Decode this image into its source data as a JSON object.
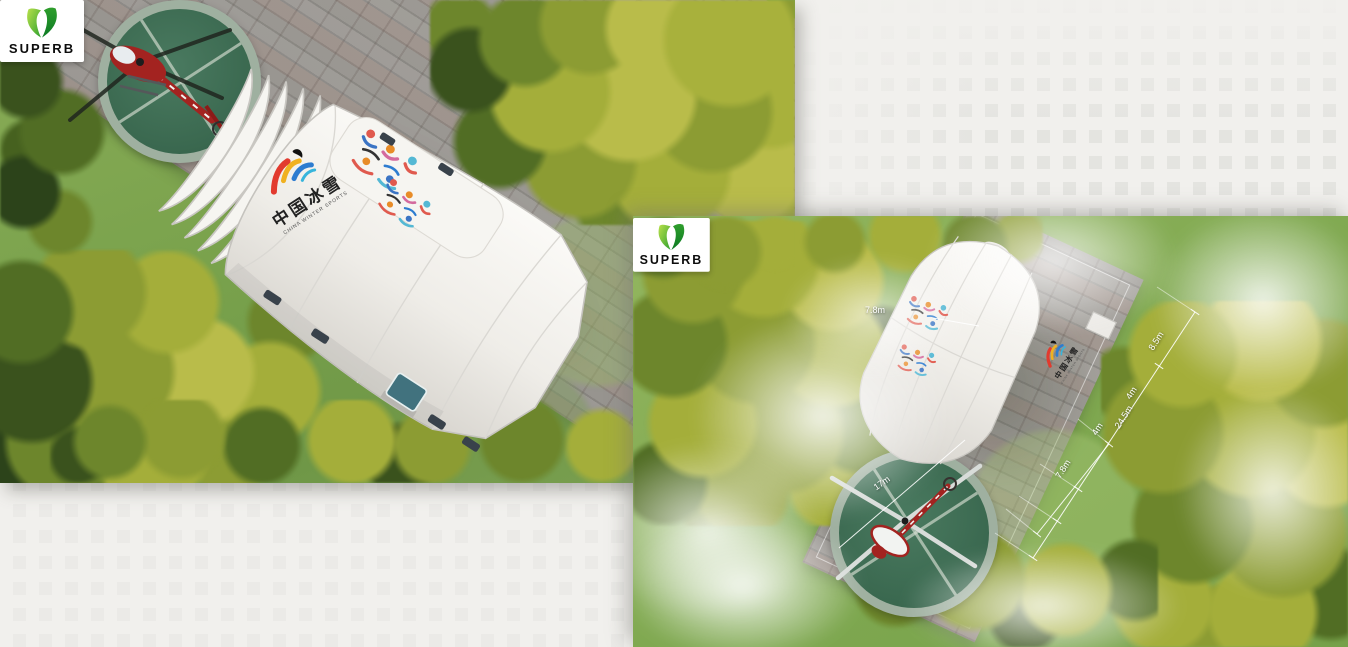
{
  "brand": {
    "name": "SUPERB",
    "green_light": "#8dc63f",
    "green_dark": "#0f8f2f"
  },
  "tent_logo": {
    "cn": "中国冰雪",
    "en": "CHINA WINTER SPORTS"
  },
  "left_photo": {
    "badge": "SUPERB"
  },
  "right_photo": {
    "badge": "SUPERB",
    "dimensions": {
      "height_callout": "7.8m",
      "side_chain": [
        "8.5m",
        "4m",
        "24.5m",
        "4m"
      ],
      "end_width": "7.8m",
      "helipad_width": "17m"
    }
  },
  "colors": {
    "page_bg": "#f1f0ed",
    "grass": "#7da551",
    "tree_yellow": "#b9bc4a",
    "pavement": "#9c9995",
    "helipad_green": "#3f6b52",
    "helicopter_red": "#a32320",
    "tent_white": "#f2f0ec",
    "logo_red": "#e23a2e",
    "logo_yellow": "#f0b120",
    "logo_blue": "#2d7cd0",
    "logo_cyan": "#37b5dc"
  }
}
